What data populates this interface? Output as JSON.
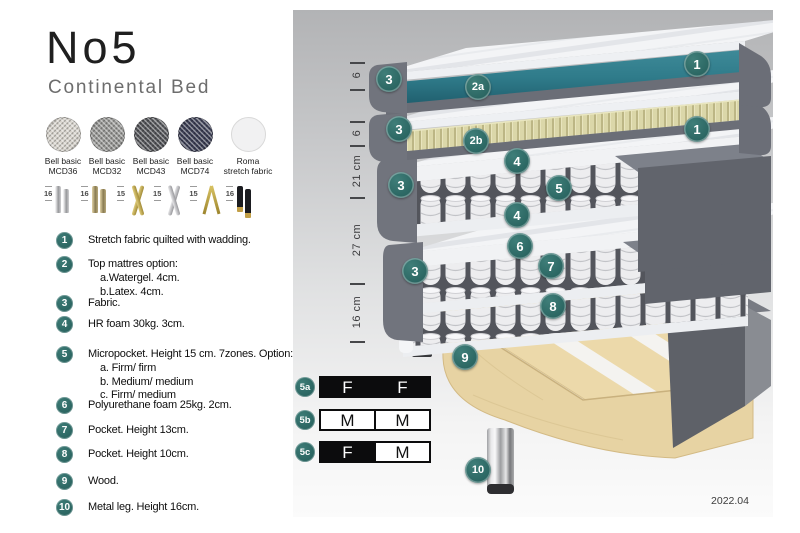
{
  "header": {
    "title": "No5",
    "subtitle": "Continental Bed"
  },
  "fabrics": [
    {
      "name_line1": "Bell basic",
      "name_line2": "MCD36",
      "color": "#d9d5ce",
      "weave": true
    },
    {
      "name_line1": "Bell basic",
      "name_line2": "MCD32",
      "color": "#989896",
      "weave": true
    },
    {
      "name_line1": "Bell basic",
      "name_line2": "MCD43",
      "color": "#54555a",
      "weave": true
    },
    {
      "name_line1": "Bell basic",
      "name_line2": "MCD74",
      "color": "#3c3f55",
      "weave": true
    },
    {
      "name_line1": "Roma",
      "name_line2": "stretch fabric",
      "color": "#f1f1f2",
      "weave": false
    }
  ],
  "legs": [
    {
      "height": "16",
      "style": "cylinder-silver"
    },
    {
      "height": "16",
      "style": "cylinder-bronze"
    },
    {
      "height": "15",
      "style": "cross-gold"
    },
    {
      "height": "15",
      "style": "cross-silver"
    },
    {
      "height": "15",
      "style": "hairpin-gold"
    },
    {
      "height": "16",
      "style": "cylinder-blackgold"
    }
  ],
  "features": [
    {
      "num": "1",
      "lines": [
        "Stretch fabric quilted with wadding."
      ]
    },
    {
      "num": "2",
      "lines": [
        "Top mattres option:",
        "a.Watergel. 4cm.",
        "b.Latex. 4cm."
      ]
    },
    {
      "num": "3",
      "lines": [
        "Fabric."
      ]
    },
    {
      "num": "4",
      "lines": [
        "HR foam 30kg. 3cm."
      ]
    },
    {
      "num": "5",
      "lines": [
        "Micropocket. Height 15 cm. 7zones. Option:",
        "a. Firm/ firm",
        "b. Medium/ medium",
        "c. Firm/ medium"
      ]
    },
    {
      "num": "6",
      "lines": [
        "Polyurethane foam 25kg. 2cm."
      ]
    },
    {
      "num": "7",
      "lines": [
        "Pocket. Height 13cm."
      ]
    },
    {
      "num": "8",
      "lines": [
        "Pocket. Height 10cm."
      ]
    },
    {
      "num": "9",
      "lines": [
        "Wood."
      ]
    },
    {
      "num": "10",
      "lines": [
        "Metal leg. Height 16cm."
      ]
    }
  ],
  "diagram": {
    "dimensions": [
      {
        "label": "6"
      },
      {
        "label": "6"
      },
      {
        "label": "21 cm"
      },
      {
        "label": "27 cm"
      },
      {
        "label": "16 cm"
      }
    ],
    "badges": [
      {
        "label": "3",
        "x": 96,
        "y": 69
      },
      {
        "label": "2a",
        "x": 185,
        "y": 77
      },
      {
        "label": "1",
        "x": 404,
        "y": 54
      },
      {
        "label": "3",
        "x": 106,
        "y": 119
      },
      {
        "label": "2b",
        "x": 183,
        "y": 131
      },
      {
        "label": "1",
        "x": 404,
        "y": 119
      },
      {
        "label": "4",
        "x": 224,
        "y": 151
      },
      {
        "label": "3",
        "x": 108,
        "y": 175
      },
      {
        "label": "5",
        "x": 266,
        "y": 178
      },
      {
        "label": "4",
        "x": 224,
        "y": 205
      },
      {
        "label": "6",
        "x": 227,
        "y": 236
      },
      {
        "label": "3",
        "x": 122,
        "y": 261
      },
      {
        "label": "7",
        "x": 258,
        "y": 256
      },
      {
        "label": "8",
        "x": 260,
        "y": 296
      },
      {
        "label": "9",
        "x": 172,
        "y": 347
      },
      {
        "label": "10",
        "x": 185,
        "y": 460
      }
    ],
    "firmness_rows": [
      {
        "id": "5a",
        "cells": [
          {
            "letter": "F",
            "fill": "black"
          },
          {
            "letter": "F",
            "fill": "black"
          }
        ]
      },
      {
        "id": "5b",
        "cells": [
          {
            "letter": "M",
            "fill": "white"
          },
          {
            "letter": "M",
            "fill": "white"
          }
        ]
      },
      {
        "id": "5c",
        "cells": [
          {
            "letter": "F",
            "fill": "black"
          },
          {
            "letter": "M",
            "fill": "white"
          }
        ]
      }
    ],
    "version": "2022.04"
  },
  "colors": {
    "badge_teal": "#2e6e69",
    "topper_teal": "#2f7b8a",
    "latex_tan": "#dbd7a9",
    "fabric_gray": "#6b6e77",
    "wood": "#ecd9aa"
  }
}
